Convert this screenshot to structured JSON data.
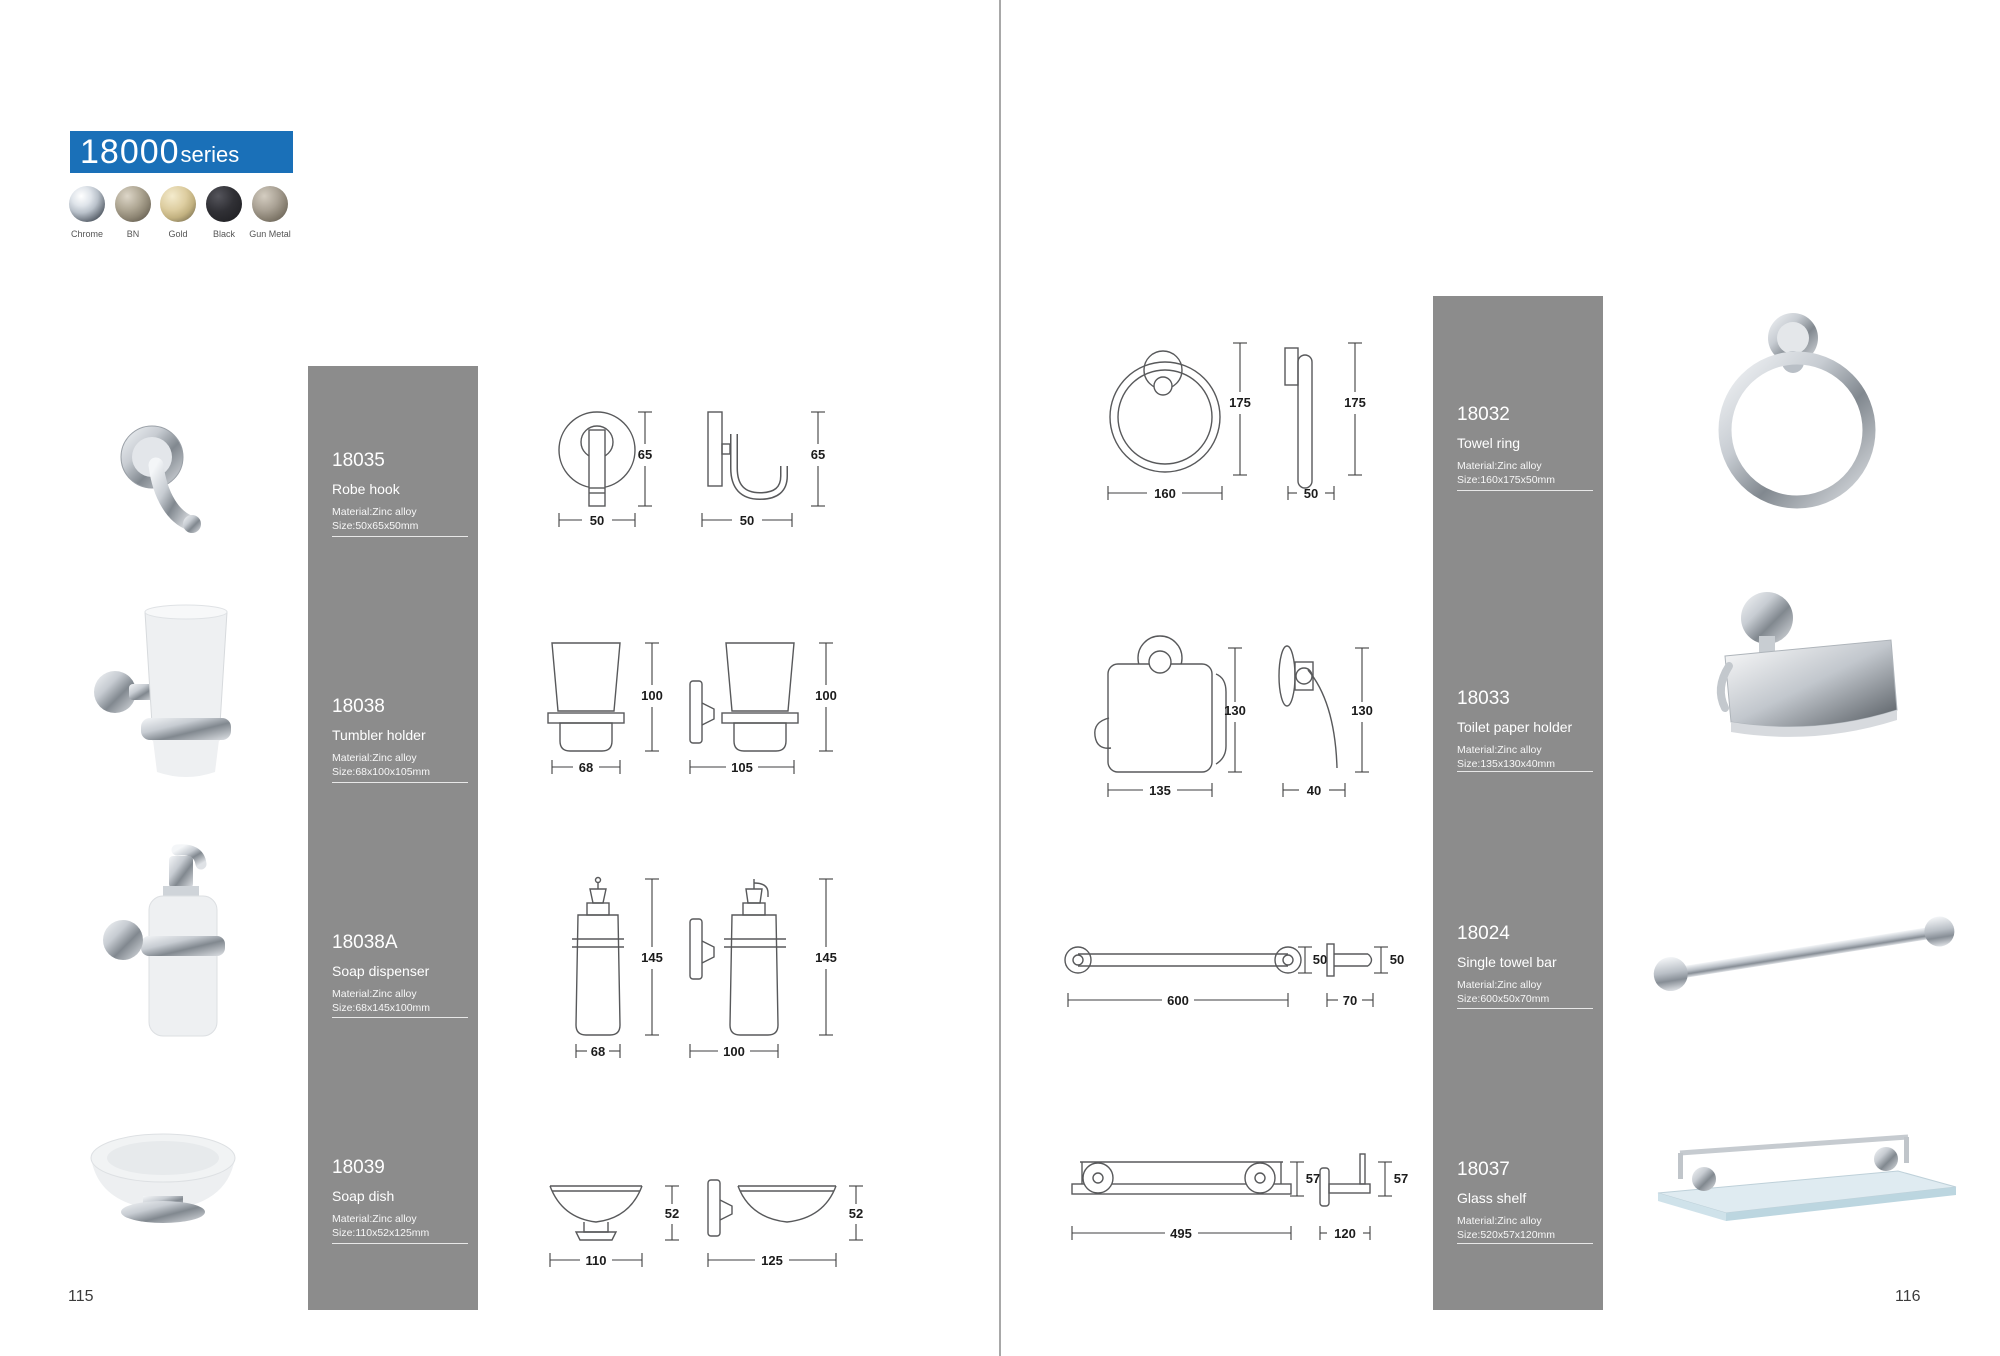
{
  "header": {
    "series_number": "18000",
    "series_word": "series"
  },
  "finishes": [
    {
      "label": "Chrome",
      "color": "#c6ccd2"
    },
    {
      "label": "BN",
      "color": "#8f8775"
    },
    {
      "label": "Gold",
      "color": "#d8c89c"
    },
    {
      "label": "Black",
      "color": "#26262a"
    },
    {
      "label": "Gun Metal",
      "color": "#9d968a"
    }
  ],
  "colors": {
    "accent_blue": "#1a70b8",
    "column_gray": "#8c8c8c"
  },
  "left_page": {
    "page_number": "115",
    "products": [
      {
        "code": "18035",
        "name": "Robe hook",
        "material": "Material:Zinc alloy",
        "size": "Size:50x65x50mm",
        "front_w": "50",
        "front_h": "65",
        "side_w": "50",
        "side_h": "65"
      },
      {
        "code": "18038",
        "name": "Tumbler holder",
        "material": "Material:Zinc alloy",
        "size": "Size:68x100x105mm",
        "front_w": "68",
        "front_h": "100",
        "side_w": "105",
        "side_h": "100"
      },
      {
        "code": "18038A",
        "name": "Soap dispenser",
        "material": "Material:Zinc alloy",
        "size": "Size:68x145x100mm",
        "front_w": "68",
        "front_h": "145",
        "side_w": "100",
        "side_h": "145"
      },
      {
        "code": "18039",
        "name": "Soap dish",
        "material": "Material:Zinc alloy",
        "size": "Size:110x52x125mm",
        "front_w": "110",
        "front_h": "52",
        "side_w": "125",
        "side_h": "52"
      }
    ]
  },
  "right_page": {
    "page_number": "116",
    "products": [
      {
        "code": "18032",
        "name": "Towel ring",
        "material": "Material:Zinc alloy",
        "size": "Size:160x175x50mm",
        "front_w": "160",
        "front_h": "175",
        "side_w": "50",
        "side_h": "175"
      },
      {
        "code": "18033",
        "name": "Toilet paper holder",
        "material": "Material:Zinc alloy",
        "size": "Size:135x130x40mm",
        "front_w": "135",
        "front_h": "130",
        "side_w": "40",
        "side_h": "130"
      },
      {
        "code": "18024",
        "name": "Single towel bar",
        "material": "Material:Zinc alloy",
        "size": "Size:600x50x70mm",
        "front_w": "600",
        "front_h": "50",
        "side_w": "70",
        "side_h": "50"
      },
      {
        "code": "18037",
        "name": "Glass shelf",
        "material": "Material:Zinc alloy",
        "size": "Size:520x57x120mm",
        "front_w": "495",
        "front_h": "57",
        "side_w": "120",
        "side_h": "57"
      }
    ]
  }
}
